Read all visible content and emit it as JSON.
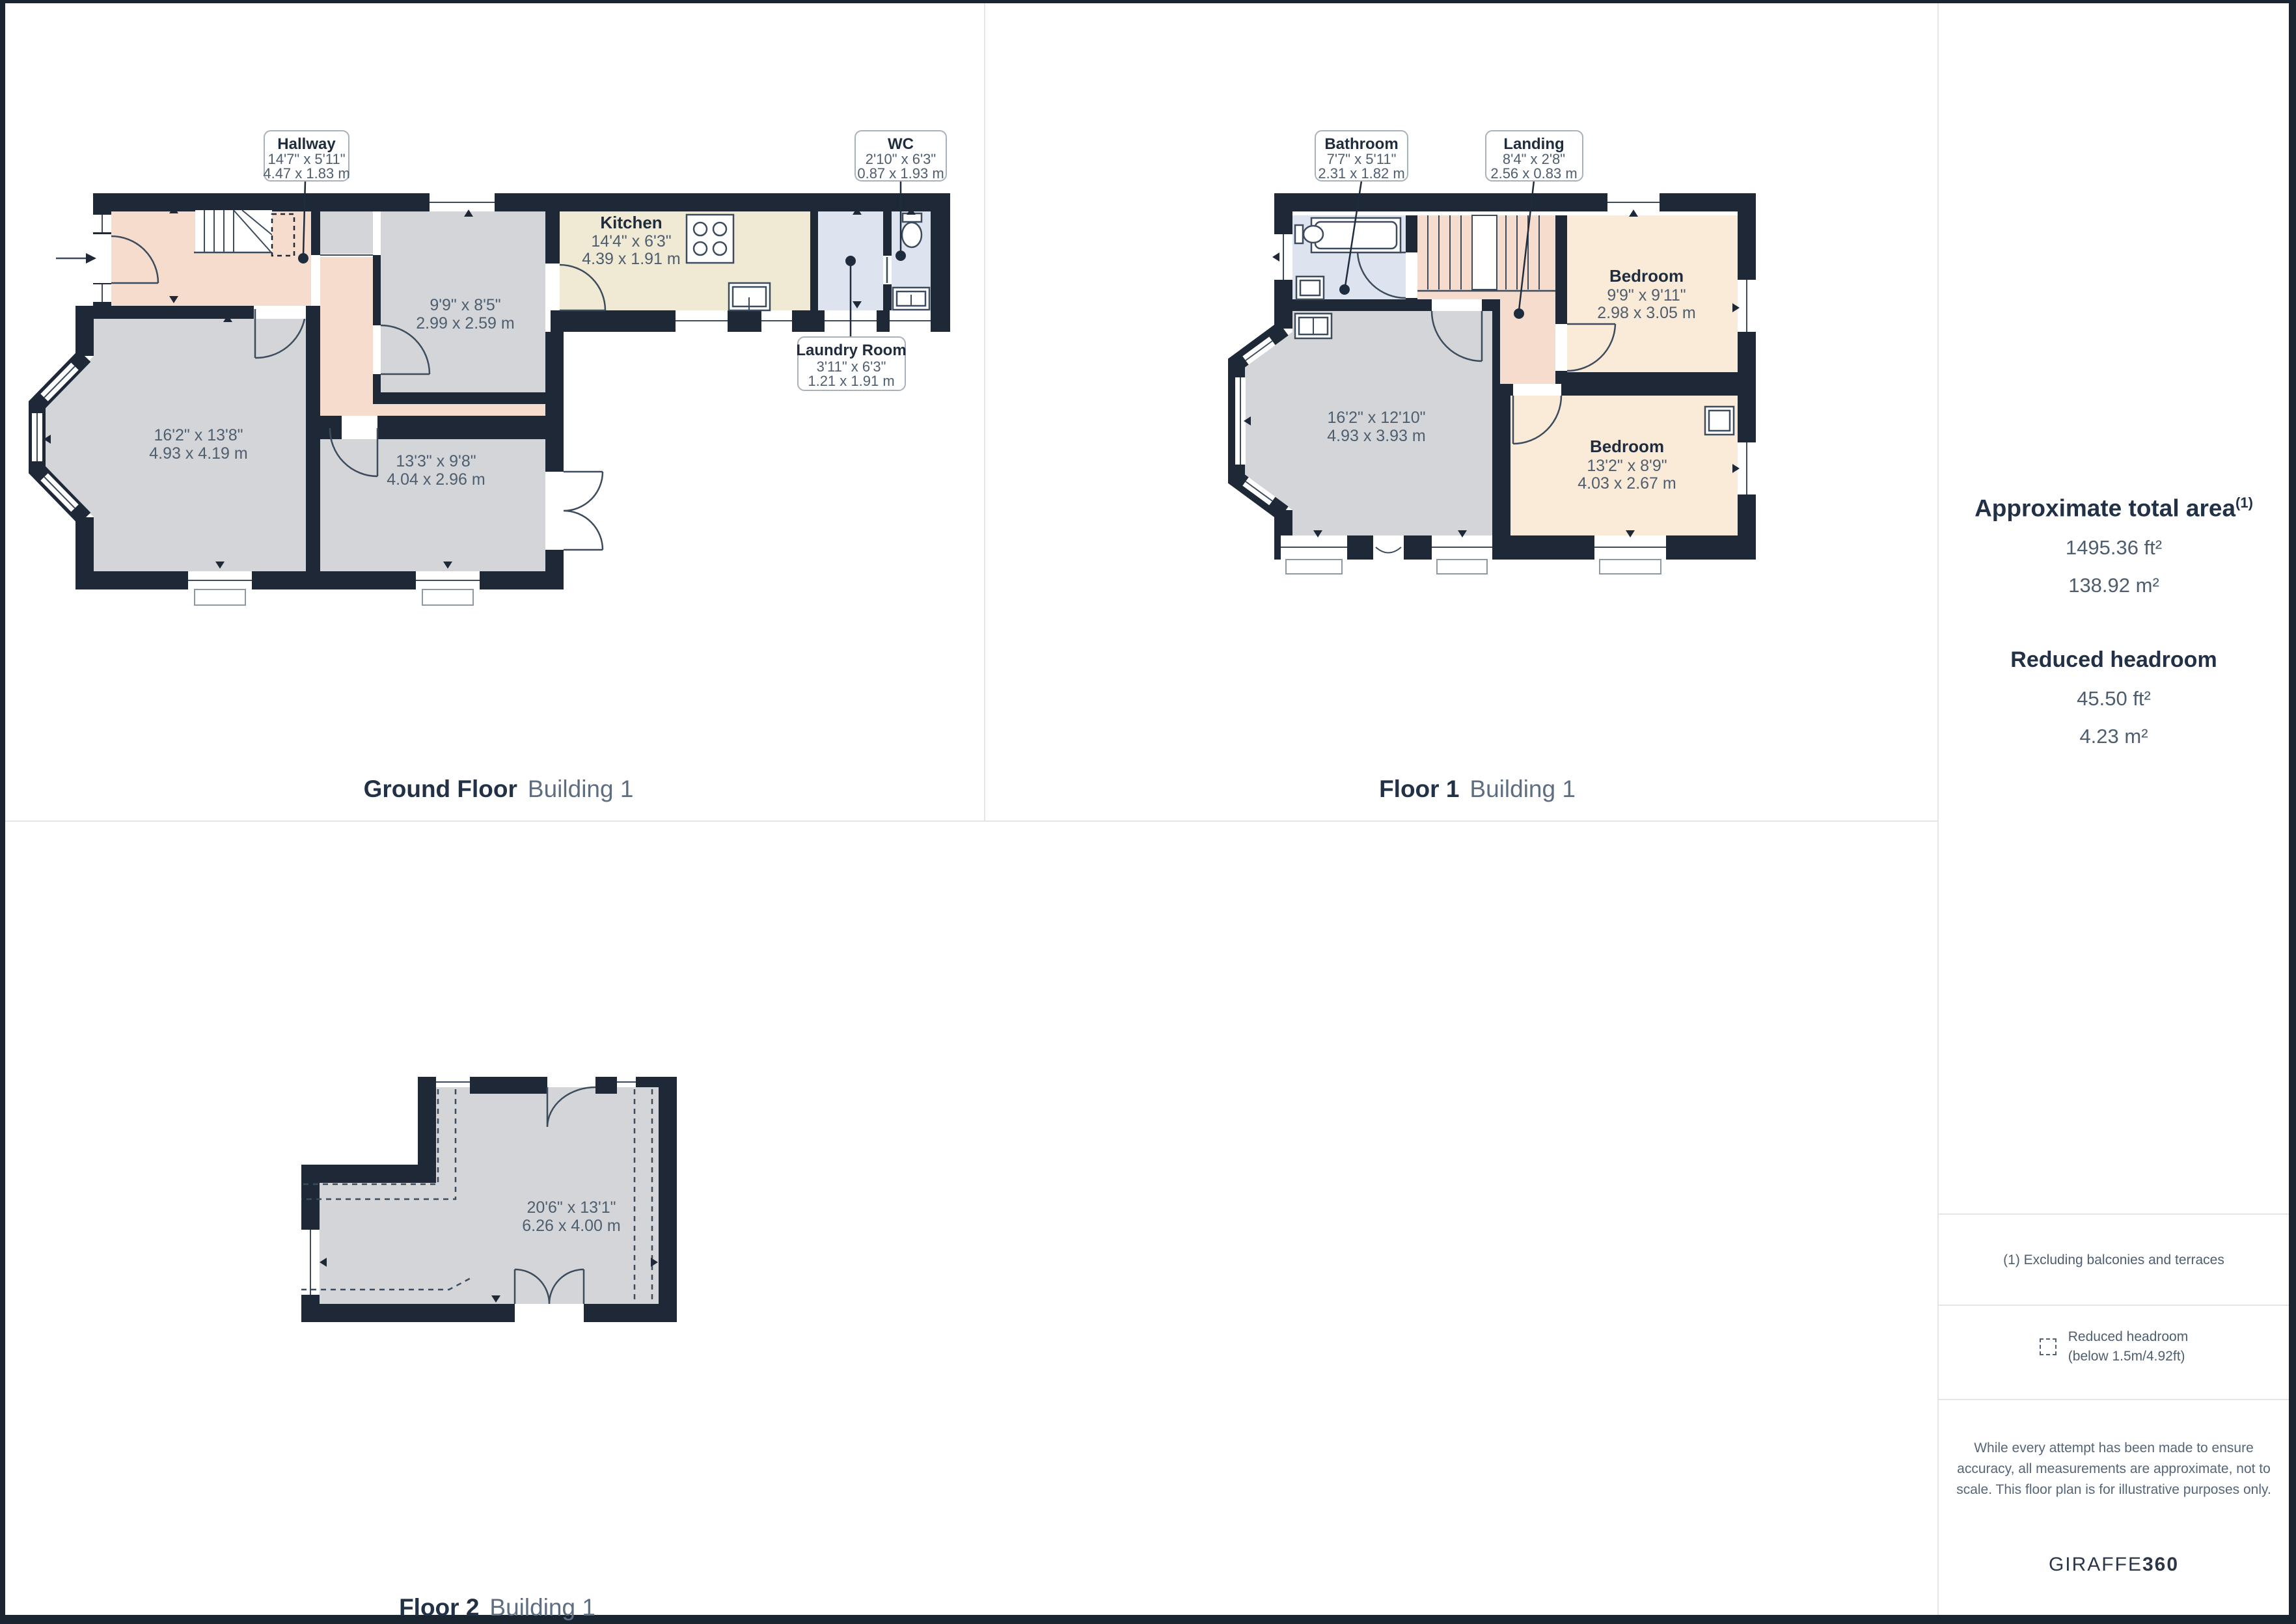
{
  "panels": {
    "ground": {
      "floor_label": "Ground Floor",
      "building": "Building 1",
      "rooms": {
        "living": {
          "imp": "16'2\" x 13'8\"",
          "met": "4.93 x 4.19 m"
        },
        "reception": {
          "imp": "13'3\" x 9'8\"",
          "met": "4.04 x 2.96 m"
        },
        "middle": {
          "imp": "9'9\" x 8'5\"",
          "met": "2.99 x 2.59 m"
        },
        "kitchen": {
          "name": "Kitchen",
          "imp": "14'4\" x 6'3\"",
          "met": "4.39 x 1.91 m"
        }
      },
      "callouts": {
        "hallway": {
          "name": "Hallway",
          "imp": "14'7\" x 5'11\"",
          "met": "4.47 x 1.83 m"
        },
        "wc": {
          "name": "WC",
          "imp": "2'10\" x 6'3\"",
          "met": "0.87 x 1.93 m"
        },
        "laundry": {
          "name": "Laundry Room",
          "imp": "3'11\" x 6'3\"",
          "met": "1.21 x 1.91 m"
        }
      }
    },
    "floor1": {
      "floor_label": "Floor 1",
      "building": "Building 1",
      "rooms": {
        "main": {
          "imp": "16'2\" x 12'10\"",
          "met": "4.93 x 3.93 m"
        },
        "bedroom1": {
          "name": "Bedroom",
          "imp": "9'9\" x 9'11\"",
          "met": "2.98 x 3.05 m"
        },
        "bedroom2": {
          "name": "Bedroom",
          "imp": "13'2\" x 8'9\"",
          "met": "4.03 x 2.67 m"
        }
      },
      "callouts": {
        "bathroom": {
          "name": "Bathroom",
          "imp": "7'7\" x 5'11\"",
          "met": "2.31 x 1.82 m"
        },
        "landing": {
          "name": "Landing",
          "imp": "8'4\" x 2'8\"",
          "met": "2.56 x 0.83 m"
        }
      }
    },
    "floor2": {
      "floor_label": "Floor 2",
      "building": "Building 1",
      "rooms": {
        "main": {
          "imp": "20'6\" x 13'1\"",
          "met": "6.26 x 4.00 m"
        }
      }
    }
  },
  "sidebar": {
    "area_title": "Approximate total area",
    "area_sup": "(1)",
    "area_ft": "1495.36 ft²",
    "area_m": "138.92 m²",
    "rh_title": "Reduced headroom",
    "rh_ft": "45.50 ft²",
    "rh_m": "4.23 m²",
    "footnote": "(1) Excluding balconies and terraces",
    "legend_line1": "Reduced headroom",
    "legend_line2": "(below 1.5m/4.92ft)",
    "disclaimer": "While every attempt has been made to ensure accuracy, all measurements are approximate, not to scale. This floor plan is for illustrative purposes only.",
    "brand_name": "GIRAFFE",
    "brand_suffix": "360"
  }
}
